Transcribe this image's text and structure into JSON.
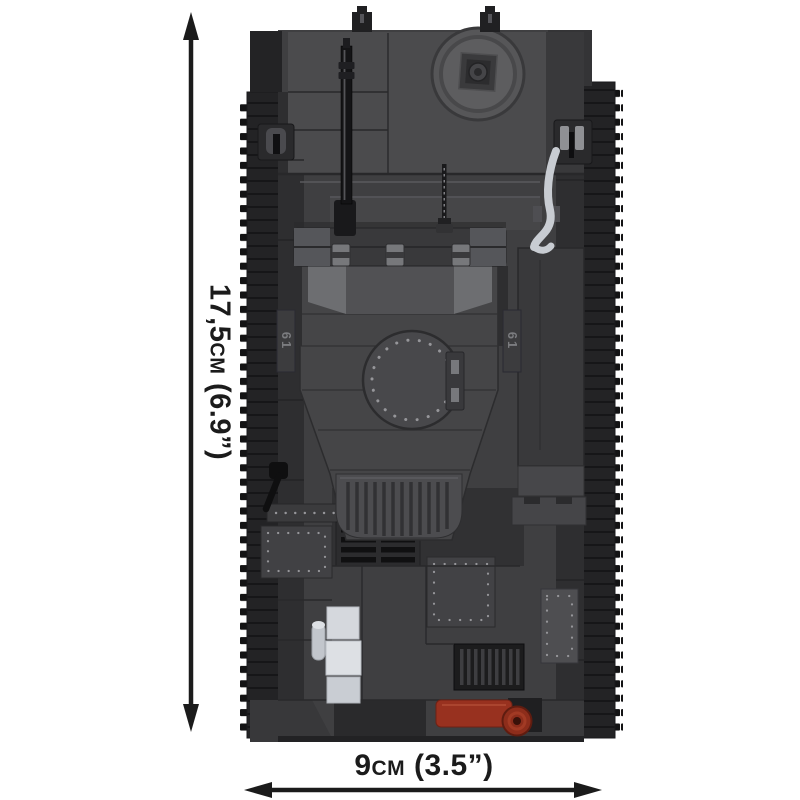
{
  "dimensions": {
    "height_label": "17,5cm (6.9”)",
    "width_label": "9cm (3.5”)"
  },
  "markings": {
    "turret_number_left": "61",
    "turret_number_right": "61"
  },
  "colors": {
    "background": "#ffffff",
    "dimension": "#1b1b1b",
    "track": "#232325",
    "teeth": "#131314",
    "fender": "#2e2e30",
    "hull": "#3f3f41",
    "hull_light": "#4b4b4d",
    "hull_dark": "#2d2d2f",
    "panel_line": "#29292b",
    "turret": "#454547",
    "turret_light": "#6d6e71",
    "hatch": "#48484b",
    "rivet": "#96969a",
    "barrel": "#141416",
    "silver": "#c8ccd2",
    "white_part": "#dde0e4",
    "brown": "#98311f"
  }
}
